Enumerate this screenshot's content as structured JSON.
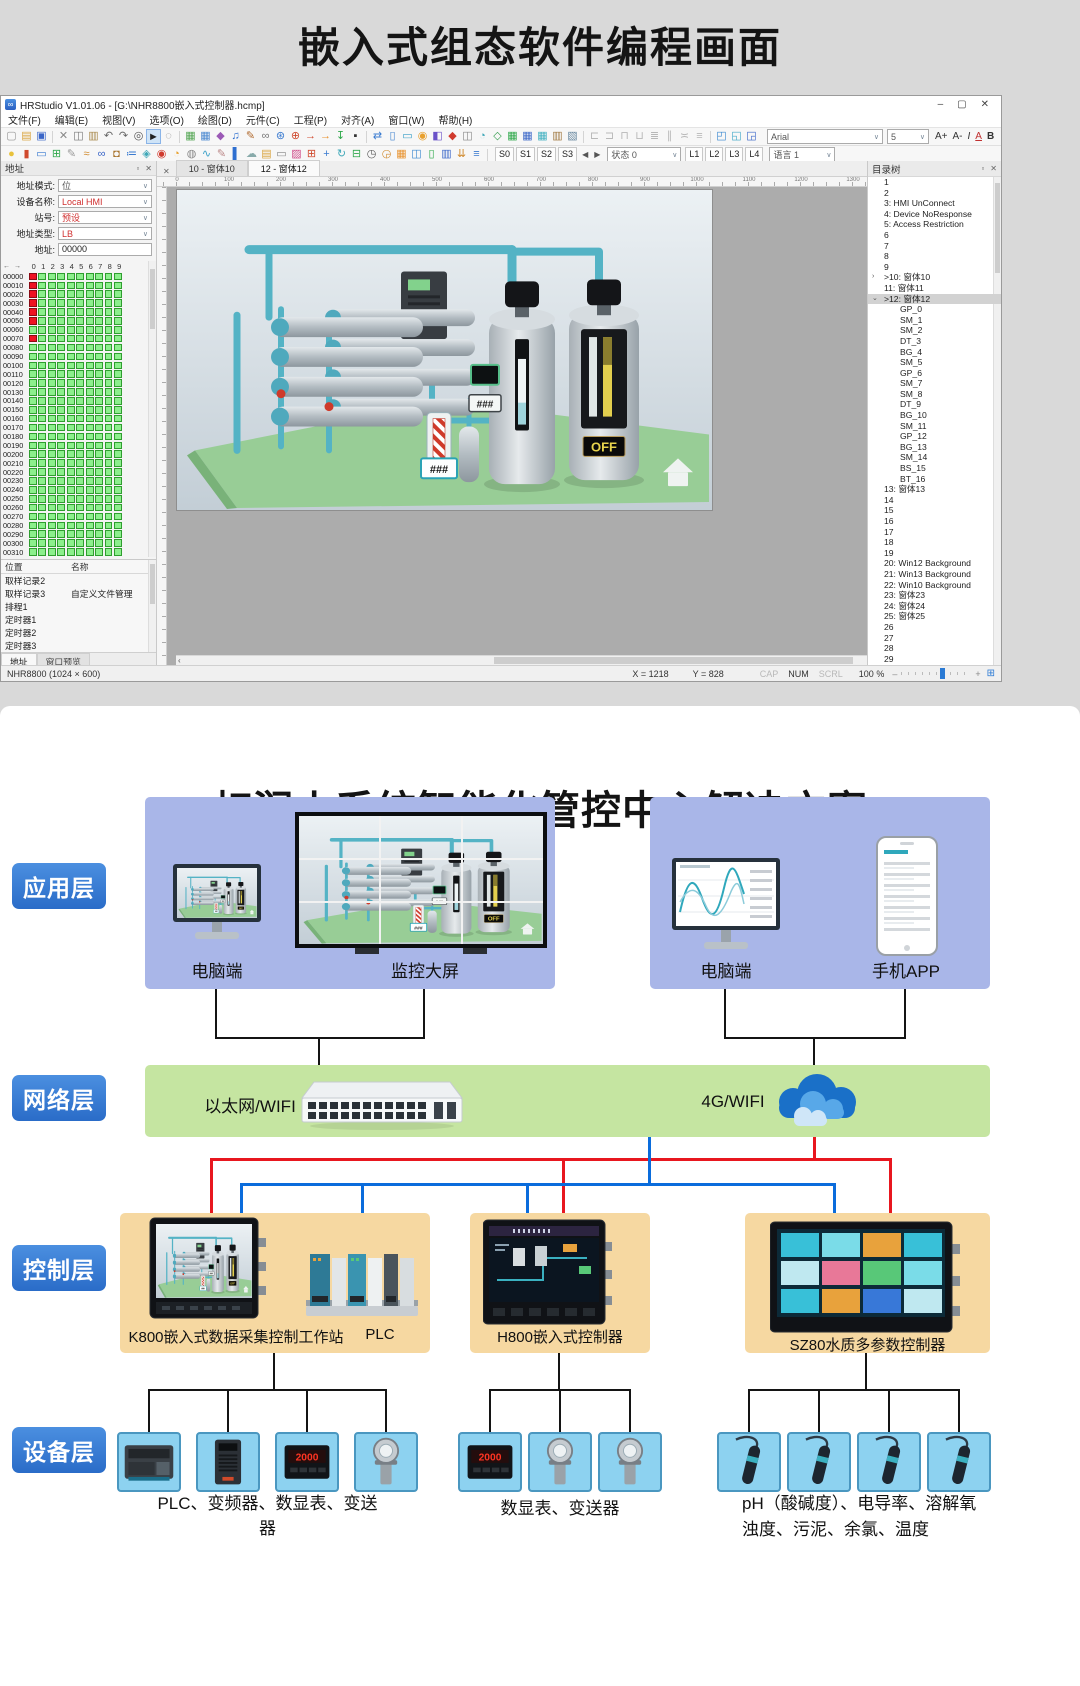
{
  "page": {
    "top_title": "嵌入式组态软件编程画面",
    "bottom_title": "虹润小系统智能化管控中心解决方案"
  },
  "window": {
    "title": "HRStudio V1.01.06 - [G:\\NHR8800嵌入式控制器.hcmp]",
    "controls": {
      "minimize": "–",
      "maximize": "▢",
      "close": "✕"
    },
    "menus": [
      "文件(F)",
      "编辑(E)",
      "视图(V)",
      "选项(O)",
      "绘图(D)",
      "元件(C)",
      "工程(P)",
      "对齐(A)",
      "窗口(W)",
      "帮助(H)"
    ],
    "toolbar1": [
      "new",
      "open",
      "save",
      "|",
      "cut",
      "copy",
      "paste",
      "undo",
      "redo",
      "find",
      "cursor",
      "hand",
      "|",
      "img",
      "tbl",
      "erz",
      "mus",
      "pen",
      "lnk",
      "gear",
      "tool",
      "ar1",
      "ar2",
      "dl",
      "dev",
      "|",
      "sync",
      "doc",
      "scr",
      "tgt",
      "cht",
      "bel",
      "cp2",
      "tag",
      "nod",
      "gg",
      "gb",
      "gc",
      "ps2",
      "st",
      "|",
      "al1",
      "al2",
      "al3",
      "al4",
      "al5",
      "al6",
      "al7",
      "al8",
      "|",
      "win1",
      "win2",
      "win3"
    ],
    "toolbar2": [
      "blb",
      "bat",
      "mon",
      "mod",
      "pe2",
      "lk2",
      "ch2",
      "lck",
      "lst",
      "tg2",
      "alm",
      "pie",
      "glb",
      "crv",
      "ed2",
      "bar",
      "cld",
      "fld",
      "wn2",
      "pht",
      "g4",
      "mov",
      "rfr",
      "lay",
      "gau",
      "clk",
      "cal",
      "cp3",
      "phn",
      "bok",
      "imp",
      "col",
      "|"
    ],
    "font_combo": "Arial",
    "size_combo": "5",
    "font_buttons": [
      "A+",
      "A-",
      "I",
      "A",
      "B"
    ],
    "state_buttons": [
      "S0",
      "S1",
      "S2",
      "S3"
    ],
    "state_arrows": [
      "◀",
      "▶"
    ],
    "state_combo": "状态 0",
    "lang_buttons": [
      "L1",
      "L2",
      "L3",
      "L4"
    ],
    "lang_combo": "语言 1",
    "tabs": [
      {
        "label": "10 - 窗体10",
        "active": false
      },
      {
        "label": "12 - 窗体12",
        "active": true
      }
    ],
    "ruler": {
      "start": 0,
      "step": 100,
      "count": 14,
      "px": 52
    }
  },
  "address_panel": {
    "title": "地址",
    "fields": [
      {
        "label": "地址模式:",
        "value": "位",
        "red": false
      },
      {
        "label": "设备名称:",
        "value": "Local HMI",
        "red": true
      },
      {
        "label": "站号:",
        "value": "预设",
        "red": true
      },
      {
        "label": "地址类型:",
        "value": "LB",
        "red": true
      }
    ],
    "addr_label": "地址:",
    "addr_value": "00000",
    "grid": {
      "nav": "← →",
      "col_headers": [
        "0",
        "1",
        "2",
        "3",
        "4",
        "5",
        "6",
        "7",
        "8",
        "9"
      ],
      "row_start": 0,
      "row_step": 10,
      "row_count": 32,
      "red_rows_col0": [
        0,
        1,
        2,
        3,
        4,
        5,
        7
      ]
    },
    "list": {
      "headers": [
        "位置",
        "名称"
      ],
      "rows": [
        [
          "取样记录2",
          ""
        ],
        [
          "取样记录3",
          "自定义文件管理"
        ],
        [
          "排程1",
          ""
        ],
        [
          "定时器1",
          ""
        ],
        [
          "定时器2",
          ""
        ],
        [
          "定时器3",
          ""
        ]
      ]
    },
    "bottom_tabs": [
      {
        "label": "地址",
        "active": true
      },
      {
        "label": "窗口预览",
        "active": false
      }
    ]
  },
  "tree_panel": {
    "title": "目录树",
    "items": [
      {
        "t": "1"
      },
      {
        "t": "2"
      },
      {
        "t": "3:  HMI UnConnect"
      },
      {
        "t": "4:  Device NoResponse"
      },
      {
        "t": "5:  Access Restriction"
      },
      {
        "t": "6"
      },
      {
        "t": "7"
      },
      {
        "t": "8"
      },
      {
        "t": "9"
      },
      {
        "t": ">10:  窗体10",
        "chev": "›"
      },
      {
        "t": "11:  窗体11"
      },
      {
        "t": ">12:  窗体12",
        "chev": "⌄",
        "sel": true
      },
      {
        "t": "GP_0",
        "ind": 1
      },
      {
        "t": "SM_1",
        "ind": 1
      },
      {
        "t": "SM_2",
        "ind": 1
      },
      {
        "t": "DT_3",
        "ind": 1
      },
      {
        "t": "BG_4",
        "ind": 1
      },
      {
        "t": "SM_5",
        "ind": 1
      },
      {
        "t": "GP_6",
        "ind": 1
      },
      {
        "t": "SM_7",
        "ind": 1
      },
      {
        "t": "SM_8",
        "ind": 1
      },
      {
        "t": "DT_9",
        "ind": 1
      },
      {
        "t": "BG_10",
        "ind": 1
      },
      {
        "t": "SM_11",
        "ind": 1
      },
      {
        "t": "GP_12",
        "ind": 1
      },
      {
        "t": "BG_13",
        "ind": 1
      },
      {
        "t": "SM_14",
        "ind": 1
      },
      {
        "t": "BS_15",
        "ind": 1
      },
      {
        "t": "BT_16",
        "ind": 1
      },
      {
        "t": "13:  窗体13"
      },
      {
        "t": "14"
      },
      {
        "t": "15"
      },
      {
        "t": "16"
      },
      {
        "t": "17"
      },
      {
        "t": "18"
      },
      {
        "t": "19"
      },
      {
        "t": "20:  Win12 Background"
      },
      {
        "t": "21:  Win13 Background"
      },
      {
        "t": "22:  Win10 Background"
      },
      {
        "t": "23:  窗体23"
      },
      {
        "t": "24:  窗体24"
      },
      {
        "t": "25:  窗体25"
      },
      {
        "t": "26"
      },
      {
        "t": "27"
      },
      {
        "t": "28"
      },
      {
        "t": "29"
      }
    ]
  },
  "status_bar": {
    "left": "NHR8800 (1024 × 600)",
    "x": "X = 1218",
    "y": "Y = 828",
    "flags": [
      {
        "label": "CAP",
        "on": false
      },
      {
        "label": "NUM",
        "on": true
      },
      {
        "label": "SCRL",
        "on": false
      }
    ],
    "zoom": "100 %",
    "minus": "–",
    "plus": "+"
  },
  "scene": {
    "display_a": "###",
    "display_b": "###",
    "off_button": "OFF"
  },
  "diagram": {
    "layer_badges": [
      "应用层",
      "网络层",
      "控制层",
      "设备层"
    ],
    "app_left_labels": [
      "电脑端",
      "监控大屏"
    ],
    "app_right_labels": [
      "电脑端",
      "手机APP"
    ],
    "network_labels": [
      "以太网/WIFI",
      "4G/WIFI"
    ],
    "control_panels": [
      {
        "label": "K800嵌入式数据采集控制工作站",
        "label2": "PLC"
      },
      {
        "label": "H800嵌入式控制器"
      },
      {
        "label": "SZ80水质多参数控制器"
      }
    ],
    "meter_reading": "2000",
    "device_groups": [
      {
        "icons": [
          "plc",
          "vfd",
          "meter",
          "transmitter"
        ],
        "caption": "PLC、变频器、数显表、变送器"
      },
      {
        "icons": [
          "meter",
          "transmitter",
          "transmitter"
        ],
        "caption": "数显表、变送器"
      },
      {
        "icons": [
          "probe",
          "probe",
          "probe",
          "probe"
        ],
        "caption": "pH（酸碱度）、电导率、溶解氧",
        "caption2": "浊度、污泥、余氯、温度"
      }
    ]
  },
  "colors": {
    "accent_blue": "#2a6cc8",
    "line_red": "#e8171f",
    "line_blue": "#0a6cdc",
    "panel_app": "#a9b6e8",
    "panel_net": "#c5e5a1",
    "panel_ctrl": "#f6d8a1",
    "device_box": "#8dd2f0",
    "cell_green": "#8cef8c",
    "cell_red": "#ee1222"
  }
}
